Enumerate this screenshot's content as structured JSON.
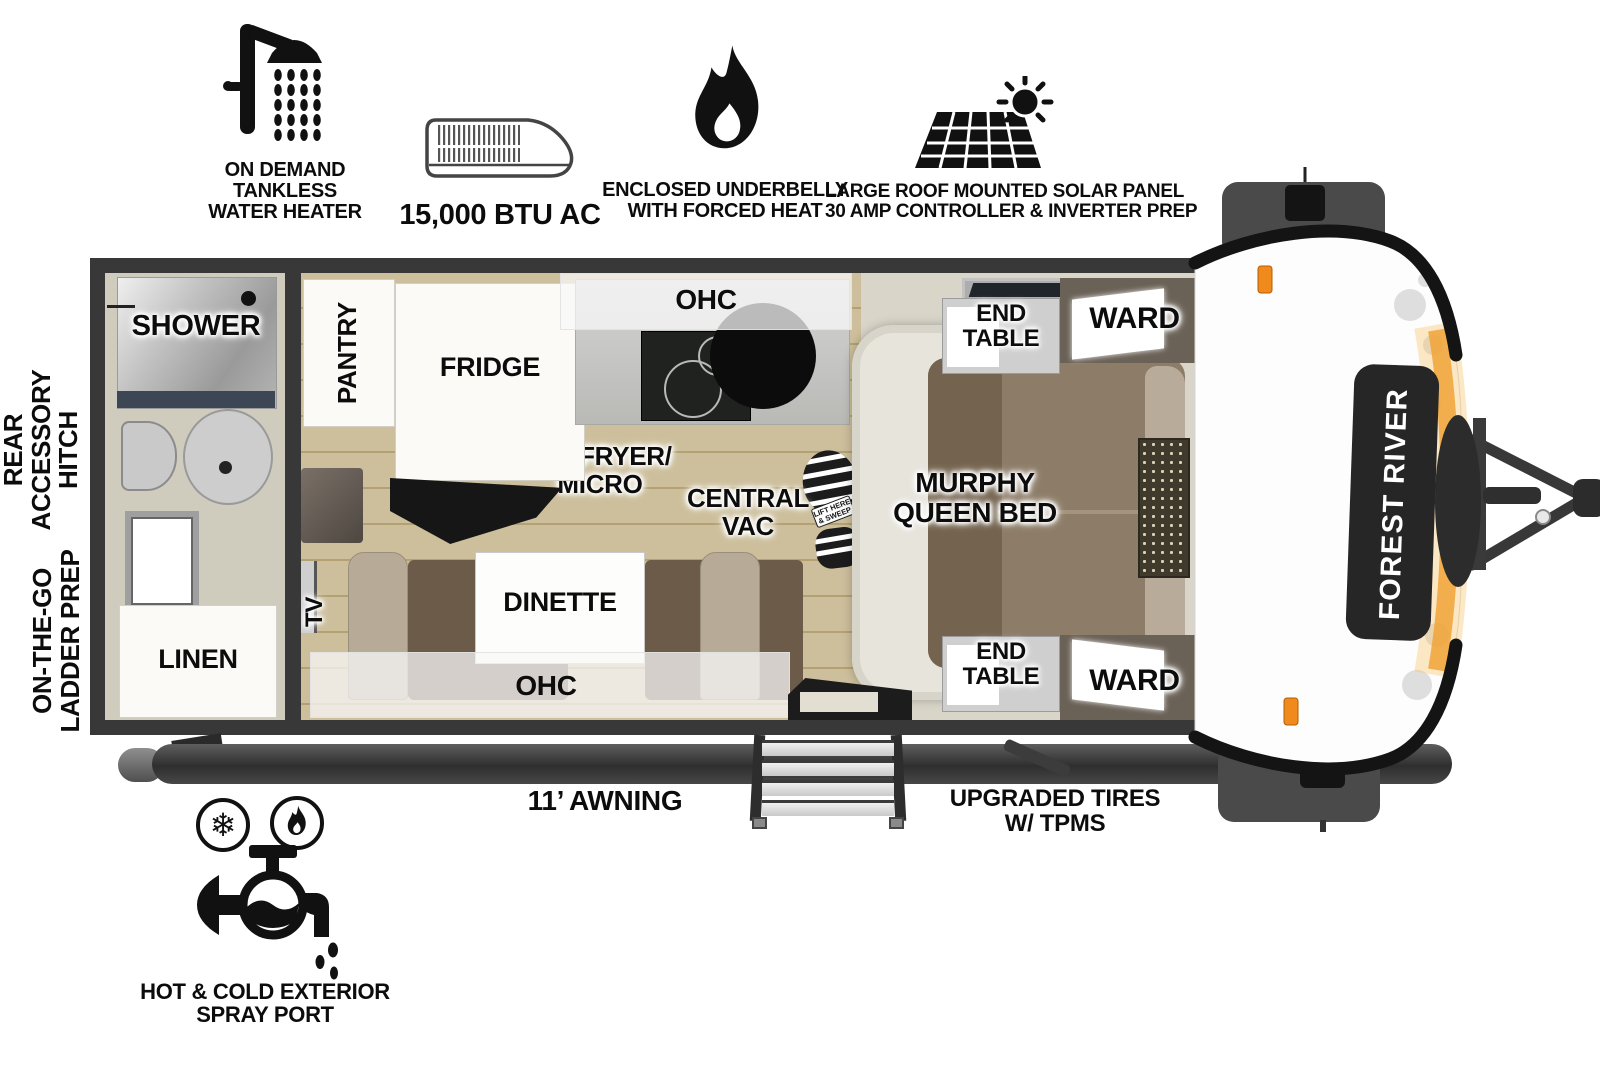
{
  "features": {
    "water_heater": {
      "lines": [
        "ON DEMAND",
        "TANKLESS",
        "WATER HEATER"
      ]
    },
    "ac": {
      "label": "15,000 BTU AC"
    },
    "underbelly": {
      "lines": [
        "ENCLOSED UNDERBELLY",
        "WITH FORCED HEAT"
      ]
    },
    "solar": {
      "lines": [
        "LARGE ROOF MOUNTED SOLAR PANEL",
        "30 AMP CONTROLLER & INVERTER PREP"
      ]
    },
    "spray_port": {
      "lines": [
        "HOT & COLD EXTERIOR",
        "SPRAY PORT"
      ]
    },
    "awning": {
      "label": "11’ AWNING"
    },
    "tires": {
      "lines": [
        "UPGRADED TIRES",
        "W/ TPMS"
      ]
    }
  },
  "exterior_labels": {
    "rear_hitch": {
      "lines": [
        "REAR",
        "ACCESSORY",
        "HITCH"
      ]
    },
    "ladder": {
      "lines": [
        "ON-THE-GO",
        "LADDER PREP"
      ]
    }
  },
  "rooms": {
    "shower": "SHOWER",
    "linen": "LINEN",
    "pantry": "PANTRY",
    "fridge": "FRIDGE",
    "ohc_kitchen": "OHC",
    "air_fryer": {
      "lines": [
        "AIR FRYER/",
        "MICRO"
      ]
    },
    "central_vac": {
      "lines": [
        "CENTRAL",
        "VAC"
      ]
    },
    "vac_sticker": {
      "lines": [
        "LIFT HERE",
        "& SWEEP"
      ]
    },
    "murphy_bed": {
      "lines": [
        "MURPHY",
        "QUEEN BED"
      ]
    },
    "end_table_front": {
      "lines": [
        "END",
        "TABLE"
      ]
    },
    "ward_front": "WARD",
    "end_table_rear": {
      "lines": [
        "END",
        "TABLE"
      ]
    },
    "ward_rear": "WARD",
    "tv": "TV",
    "dinette": "DINETTE",
    "ohc_dinette": "OHC"
  },
  "brand": {
    "name": "FOREST RIVER"
  },
  "colors": {
    "wall": "#383838",
    "wood_floor": "#cdbf9c",
    "accent_orange": "#f0941f",
    "sofa_brown": "#8b7b66"
  }
}
